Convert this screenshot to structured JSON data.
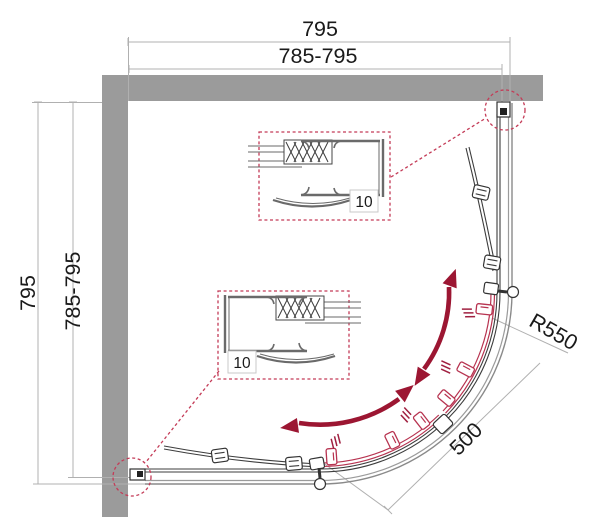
{
  "drawing": {
    "title": "quadrant-shower-enclosure-plan",
    "dim_width_total": "795",
    "dim_width_range": "785-795",
    "dim_height_total": "795",
    "dim_height_range": "785-795",
    "dim_radius": "R550",
    "dim_door_opening": "500",
    "detail_top_value": "10",
    "detail_bottom_value": "10"
  },
  "colors": {
    "wall": "#9b9b9b",
    "line_dark": "#3d3d3d",
    "line_mid": "#6a6a6a",
    "line_light": "#b0b0b0",
    "accent_red": "#c43b57",
    "door_red": "#b73350",
    "hatch_red": "#a02040",
    "arrow_red": "#9c1632",
    "text": "#1a1a1a"
  }
}
